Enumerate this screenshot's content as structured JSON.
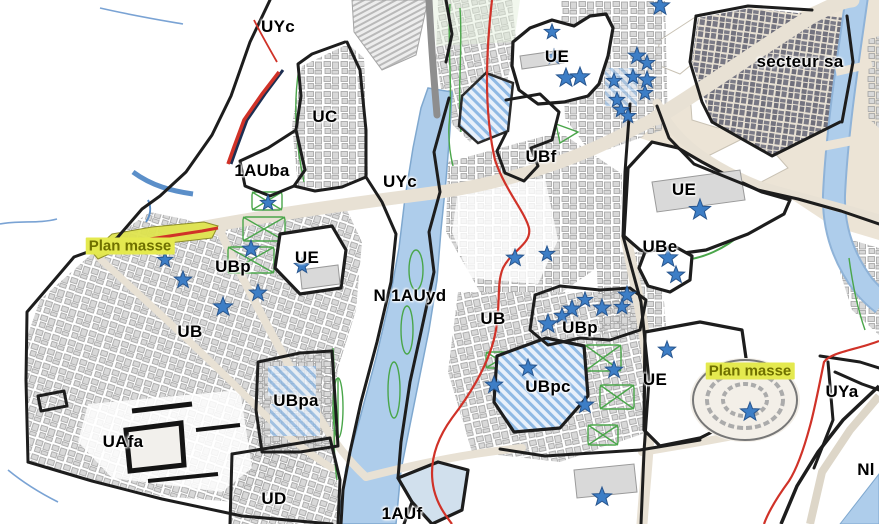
{
  "map": {
    "description": "Urban zoning map (plan de zonage) with zone labels, protected-site stars and plan masse areas",
    "zone_labels": [
      {
        "text": "UYc",
        "x": 278,
        "y": 27
      },
      {
        "text": "UC",
        "x": 325,
        "y": 117
      },
      {
        "text": "1AUba",
        "x": 262,
        "y": 171
      },
      {
        "text": "UYc",
        "x": 400,
        "y": 182
      },
      {
        "text": "UE",
        "x": 557,
        "y": 57
      },
      {
        "text": "UBf",
        "x": 541,
        "y": 157
      },
      {
        "text": "secteur sa",
        "x": 800,
        "y": 62
      },
      {
        "text": "UE",
        "x": 684,
        "y": 190
      },
      {
        "text": "UBp",
        "x": 233,
        "y": 267
      },
      {
        "text": "UE",
        "x": 307,
        "y": 258
      },
      {
        "text": "UB",
        "x": 190,
        "y": 332
      },
      {
        "text": "N 1AUyd",
        "x": 410,
        "y": 296
      },
      {
        "text": "UB",
        "x": 493,
        "y": 319
      },
      {
        "text": "UBe",
        "x": 660,
        "y": 247
      },
      {
        "text": "UBp",
        "x": 580,
        "y": 328
      },
      {
        "text": "UBpc",
        "x": 548,
        "y": 387
      },
      {
        "text": "UE",
        "x": 655,
        "y": 380
      },
      {
        "text": "UBpa",
        "x": 296,
        "y": 401
      },
      {
        "text": "UAfa",
        "x": 123,
        "y": 442
      },
      {
        "text": "UD",
        "x": 274,
        "y": 499
      },
      {
        "text": "1AUf",
        "x": 402,
        "y": 514
      },
      {
        "text": "UYa",
        "x": 842,
        "y": 392
      },
      {
        "text": "Nl",
        "x": 866,
        "y": 470
      }
    ],
    "plan_masse_labels": [
      {
        "text": "Plan masse",
        "x": 130,
        "y": 246
      },
      {
        "text": "Plan masse",
        "x": 750,
        "y": 371
      }
    ],
    "stars": [
      [
        552,
        32,
        8
      ],
      [
        554,
        57,
        8
      ],
      [
        566,
        78,
        10
      ],
      [
        580,
        77,
        10
      ],
      [
        660,
        6,
        10
      ],
      [
        637,
        56,
        9
      ],
      [
        647,
        63,
        8
      ],
      [
        633,
        77,
        8
      ],
      [
        647,
        80,
        9
      ],
      [
        614,
        81,
        8
      ],
      [
        645,
        93,
        8
      ],
      [
        617,
        100,
        8
      ],
      [
        621,
        110,
        8
      ],
      [
        628,
        116,
        8
      ],
      [
        268,
        203,
        8
      ],
      [
        251,
        249,
        9
      ],
      [
        165,
        260,
        8
      ],
      [
        183,
        280,
        9
      ],
      [
        302,
        266,
        8
      ],
      [
        258,
        293,
        9
      ],
      [
        223,
        307,
        10
      ],
      [
        515,
        258,
        9
      ],
      [
        547,
        254,
        8
      ],
      [
        700,
        210,
        11
      ],
      [
        668,
        258,
        10
      ],
      [
        676,
        275,
        9
      ],
      [
        585,
        300,
        8
      ],
      [
        627,
        295,
        9
      ],
      [
        622,
        307,
        8
      ],
      [
        602,
        308,
        9
      ],
      [
        572,
        309,
        9
      ],
      [
        562,
        316,
        8
      ],
      [
        548,
        324,
        10
      ],
      [
        528,
        368,
        9
      ],
      [
        494,
        385,
        9
      ],
      [
        614,
        370,
        9
      ],
      [
        585,
        405,
        9
      ],
      [
        667,
        350,
        9
      ],
      [
        750,
        412,
        10
      ],
      [
        602,
        497,
        10
      ]
    ],
    "colors": {
      "star": "#3d7ec6",
      "star_stroke": "#28568f",
      "boundary": "#1d1d1d",
      "red_line": "#d03228",
      "green": "#4aa64a",
      "water": "#aecdeb",
      "road": "#e8e1d4",
      "plan_masse_text": "#6f7000",
      "plan_masse_bg": "#e4e94f"
    }
  }
}
